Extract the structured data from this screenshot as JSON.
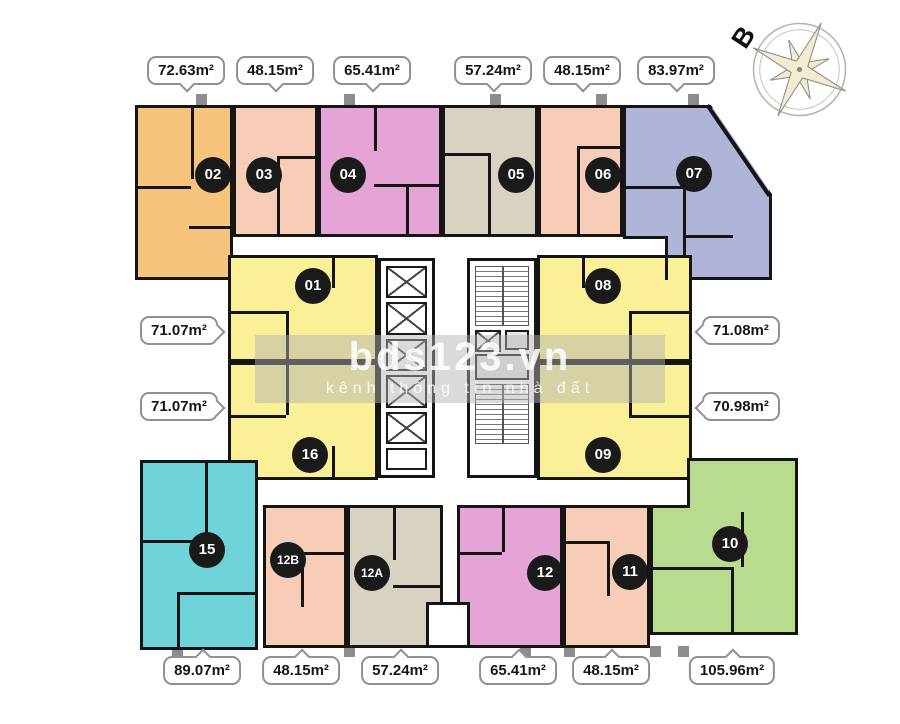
{
  "compass": {
    "north_label": "B"
  },
  "watermark": {
    "brand": "bds123.vn",
    "tagline": "kênh thông tin nhà đất"
  },
  "area_labels": {
    "top": [
      "72.63m²",
      "48.15m²",
      "65.41m²",
      "57.24m²",
      "48.15m²",
      "83.97m²"
    ],
    "left": [
      "71.07m²",
      "71.07m²"
    ],
    "right": [
      "71.08m²",
      "70.98m²"
    ],
    "bottom": [
      "89.07m²",
      "48.15m²",
      "57.24m²",
      "65.41m²",
      "48.15m²",
      "105.96m²"
    ]
  },
  "units": {
    "u01": {
      "label": "01",
      "color": "#F9F098"
    },
    "u02": {
      "label": "02",
      "color": "#F6C47C"
    },
    "u03": {
      "label": "03",
      "color": "#F8CDB8"
    },
    "u04": {
      "label": "04",
      "color": "#E4A4D6"
    },
    "u05": {
      "label": "05",
      "color": "#D8D2C2"
    },
    "u06": {
      "label": "06",
      "color": "#F8CDB8"
    },
    "u07": {
      "label": "07",
      "color": "#AFB4D8"
    },
    "u08": {
      "label": "08",
      "color": "#F9F098"
    },
    "u09": {
      "label": "09",
      "color": "#F9F098"
    },
    "u10": {
      "label": "10",
      "color": "#B8DB8E"
    },
    "u11": {
      "label": "11",
      "color": "#F8CDB8"
    },
    "u12": {
      "label": "12",
      "color": "#E4A4D6"
    },
    "u12A": {
      "label": "12A",
      "color": "#D8D2C2"
    },
    "u12B": {
      "label": "12B",
      "color": "#F8CDB8"
    },
    "u15": {
      "label": "15",
      "color": "#70D3D9"
    },
    "u16": {
      "label": "16",
      "color": "#F9F098"
    }
  }
}
